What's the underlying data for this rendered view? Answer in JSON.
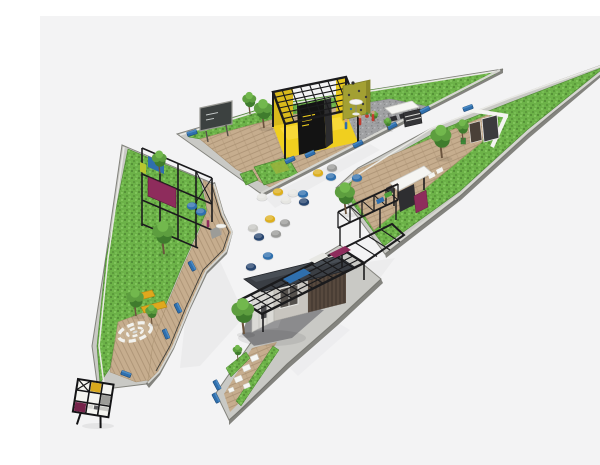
{
  "alt": "Axonometric 3D rendering of a triangular pocket park: three wedge-shaped green parcels with timber decks, a yellow pergola pavilion, an olive climbing wall, kiosks, a slat-wood pavilion under a black grid canopy, trees, blue benches and scattered round seating poufs around a central white plaza.",
  "palette": {
    "bg": "#f3f3f4",
    "grass": "#6cb248",
    "grass_dark": "#569238",
    "grass_light": "#80c45b",
    "wall_top": "#c9c9c5",
    "wall_side": "#6f6f69",
    "deck": "#c6ad8e",
    "deck_line": "#aa9174",
    "gravel": "#a0a1a3",
    "gravel_dark": "#8a8b8d",
    "gravel_light": "#b5b6b8",
    "asphalt": "#8b8b8d",
    "frame_black": "#1b1b1d",
    "accent_yellow": "#f0cf1f",
    "accent_blue": "#2f6fad",
    "accent_navy": "#27456f",
    "accent_magenta": "#8e2c5c",
    "maroon": "#75234a",
    "olive_wall": "#a3a033",
    "building_wood": "#57493e",
    "roof": "#3a3e44",
    "tree_dark": "#3f7c2d",
    "tree_mid": "#5d9e3f",
    "tree_light": "#72b84d",
    "trunk": "#6b543e",
    "pouf_yellow": "#ddaf1e",
    "pouf_gray": "#9a9a98",
    "pouf_white": "#e6e6e2",
    "pouf_lightgray": "#c6c6c2",
    "person_skin": "#caa183"
  },
  "scene": {
    "trees": [
      {
        "x": 224,
        "y": 112,
        "s": 1.05
      },
      {
        "x": 210,
        "y": 98,
        "s": 0.8
      },
      {
        "x": 306,
        "y": 198,
        "s": 1.15
      },
      {
        "x": 402,
        "y": 142,
        "s": 1.2
      },
      {
        "x": 423,
        "y": 124,
        "s": 0.75
      },
      {
        "x": 348,
        "y": 114,
        "s": 0.45
      },
      {
        "x": 335,
        "y": 106,
        "s": 0.4
      },
      {
        "x": 120,
        "y": 158,
        "s": 0.85
      },
      {
        "x": 124,
        "y": 238,
        "s": 1.2
      },
      {
        "x": 96,
        "y": 300,
        "s": 1.0
      },
      {
        "x": 112,
        "y": 308,
        "s": 0.7
      },
      {
        "x": 204,
        "y": 318,
        "s": 1.3
      },
      {
        "x": 198,
        "y": 344,
        "s": 0.55
      }
    ],
    "poufs": [
      {
        "x": 278,
        "y": 157,
        "c": "pouf_yellow"
      },
      {
        "x": 292,
        "y": 152,
        "c": "pouf_gray"
      },
      {
        "x": 291,
        "y": 161,
        "c": "accent_blue"
      },
      {
        "x": 317,
        "y": 162,
        "c": "accent_blue"
      },
      {
        "x": 253,
        "y": 177,
        "c": "pouf_white"
      },
      {
        "x": 263,
        "y": 178,
        "c": "accent_blue"
      },
      {
        "x": 264,
        "y": 186,
        "c": "accent_navy"
      },
      {
        "x": 238,
        "y": 176,
        "c": "pouf_yellow"
      },
      {
        "x": 222,
        "y": 181,
        "c": "pouf_white"
      },
      {
        "x": 246,
        "y": 184,
        "c": "pouf_white"
      },
      {
        "x": 230,
        "y": 203,
        "c": "pouf_yellow"
      },
      {
        "x": 213,
        "y": 212,
        "c": "pouf_lightgray"
      },
      {
        "x": 245,
        "y": 207,
        "c": "pouf_gray"
      },
      {
        "x": 236,
        "y": 218,
        "c": "pouf_gray"
      },
      {
        "x": 219,
        "y": 221,
        "c": "accent_navy"
      },
      {
        "x": 228,
        "y": 240,
        "c": "accent_blue"
      },
      {
        "x": 211,
        "y": 251,
        "c": "accent_navy"
      },
      {
        "x": 161,
        "y": 196,
        "c": "accent_blue"
      },
      {
        "x": 152,
        "y": 190,
        "c": "accent_blue"
      }
    ],
    "benches": [
      {
        "x": 152,
        "y": 117,
        "a": -17
      },
      {
        "x": 250,
        "y": 144,
        "a": -25
      },
      {
        "x": 270,
        "y": 138,
        "a": -25
      },
      {
        "x": 318,
        "y": 128,
        "a": -27
      },
      {
        "x": 352,
        "y": 110,
        "a": -27
      },
      {
        "x": 385,
        "y": 94,
        "a": -27
      },
      {
        "x": 428,
        "y": 92,
        "a": -20
      },
      {
        "x": 152,
        "y": 250,
        "a": 62
      },
      {
        "x": 138,
        "y": 292,
        "a": 64
      },
      {
        "x": 126,
        "y": 318,
        "a": 66
      },
      {
        "x": 86,
        "y": 358,
        "a": 20
      },
      {
        "x": 177,
        "y": 369,
        "a": 62
      },
      {
        "x": 176,
        "y": 382,
        "a": 62
      }
    ],
    "people": [
      {
        "x": 306,
        "y": 112,
        "c": "#2f6fad"
      },
      {
        "x": 320,
        "y": 108,
        "c": "#c23b2e"
      },
      {
        "x": 333,
        "y": 104,
        "c": "#c23b2e"
      },
      {
        "x": 168,
        "y": 210,
        "c": "#8e2c5c"
      }
    ]
  }
}
